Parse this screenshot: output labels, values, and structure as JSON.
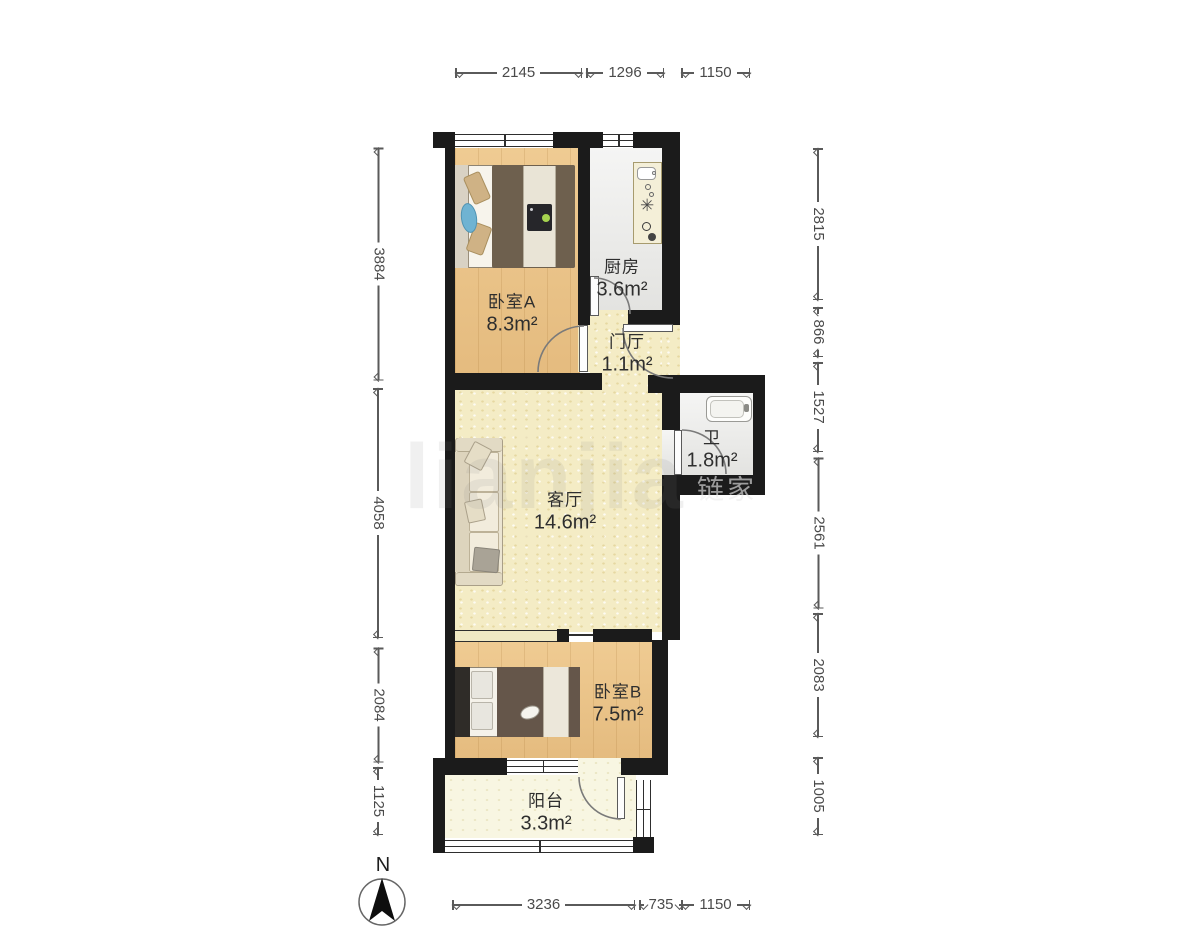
{
  "rooms": [
    {
      "id": "bedroom-a",
      "name": "卧室A",
      "area": "8.3m²"
    },
    {
      "id": "kitchen",
      "name": "厨房",
      "area": "3.6m²"
    },
    {
      "id": "hall",
      "name": "门厅",
      "area": "1.1m²"
    },
    {
      "id": "bathroom",
      "name": "卫",
      "area": "1.8m²"
    },
    {
      "id": "living",
      "name": "客厅",
      "area": "14.6m²"
    },
    {
      "id": "bedroom-b",
      "name": "卧室B",
      "area": "7.5m²"
    },
    {
      "id": "balcony",
      "name": "阳台",
      "area": "3.3m²"
    }
  ],
  "dimensions": {
    "top": [
      "2145",
      "1296",
      "1150"
    ],
    "bottom": [
      "3236",
      "735",
      "1150"
    ],
    "left": [
      "3884",
      "4058",
      "2084",
      "1125"
    ],
    "right": [
      "2815",
      "866",
      "1527",
      "2561",
      "2083",
      "1005"
    ]
  },
  "compass": {
    "label": "N"
  },
  "watermark": {
    "large": "lianjia",
    "small": "链家"
  },
  "icons": {
    "burner": "✳"
  },
  "colors": {
    "wall": "#1b1b1b",
    "wood_floor": "#eac287",
    "pale_floor": "#f4ecc5",
    "gray_floor": "#ebebe9",
    "cream_floor": "#f8f6e2",
    "dimension_text": "#4a4a4a"
  }
}
